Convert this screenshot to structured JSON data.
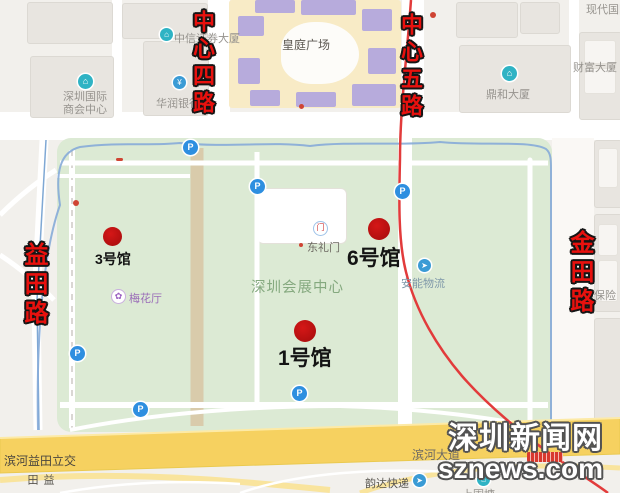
{
  "road_labels": {
    "center4": "中心四路",
    "center5": "中心五路",
    "yitian": "益田路",
    "jintian": "金田路",
    "yitian_south": "益田"
  },
  "halls": {
    "h1": "1号馆",
    "h3": "3号馆",
    "h6": "6号馆"
  },
  "venue": {
    "name": "深圳会展中心"
  },
  "pois": {
    "commerce_line1": "深圳国际",
    "commerce_line2": "商会中心",
    "citic": "中信证券大厦",
    "crbank": "华润银行",
    "mall": "皇庭广场",
    "dinghe": "鼎和大厦",
    "caifu": "财富大厦",
    "xiandai": "现代国际",
    "donglimen": "东礼门",
    "meihua": "梅花厅",
    "anneng": "安能物流",
    "aia": "友邦保险",
    "interchange": "滨河益田立交",
    "binhe_avenue": "滨河大道",
    "yunda": "韵达快递",
    "shangweitang": "上围塘"
  },
  "icons": {
    "parking": "P",
    "building": "⌂",
    "bank": "¥",
    "gate": "门",
    "flower": "✿",
    "truck": "➤",
    "courier": "➤"
  },
  "watermark": {
    "line1": "深圳新闻网",
    "line2": "sznews.com"
  },
  "colors": {
    "hall_marker_red": "#c21313",
    "road_label_red": "#e8110e",
    "route_line_red": "#e23b3b",
    "venue_green": "#dcead4",
    "highway_yellow": "#f6d160",
    "moat_blue": "#86abd8",
    "parking_blue": "#2e8fe0"
  }
}
